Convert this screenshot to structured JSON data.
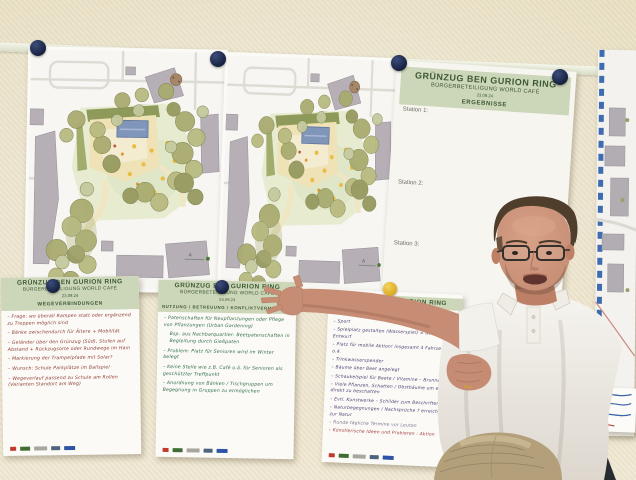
{
  "colors": {
    "wall": "#ece4cc",
    "poster_band": "#ccd6b8",
    "band_text": "#3d5a33",
    "magnet_navy": "#1c2844",
    "magnet_yellow": "#e3b52e",
    "ink_red": "#8c3a2e",
    "ink_green": "#2e6b44",
    "ink_purple": "#4a3b6e"
  },
  "results_poster": {
    "title": "GRÜNZUG BEN GURION RING",
    "subtitle": "BÜRGERBETEILIGUNG WORLD CAFÉ",
    "date": "23.09.24",
    "section": "ERGEBNISSE",
    "stations": [
      "Station 1:",
      "Station 2:",
      "Station 3:"
    ]
  },
  "note_posters": [
    {
      "title": "GRÜNZUG BEN GURION RING",
      "subtitle": "BÜRGERBETEILIGUNG WORLD CAFÉ",
      "date": "23.09.24",
      "section": "WEGEVERBINDUNGEN",
      "items": [
        "– Frage: wo überall Rampen statt oder ergänzend zu Treppen möglich sind",
        "– Bänke zwischendurch für Ältere + Mobilität",
        "– Geländer über den Grünzug (Süd), Stufen auf Abstand + Rückzugsorte oder Rundwege im Hain",
        "– Markierung der Trampelpfade mit Solar?",
        "– Wunsch: Schule Parkplätze im Ballspiel",
        "– Wegeverlauf passend zu Schule am Rollen (Varianten Standort am Weg)"
      ]
    },
    {
      "title": "GRÜNZUG BEN GURION RING",
      "subtitle": "BÜRGERBETEILIGUNG WORLD CAFÉ",
      "date": "23.09.24",
      "section": "NUTZUNG / BETREUUNG / KONFLIKTVERMEIDUNG",
      "items": [
        "– Patenschaften für Neupflanzungen oder Pflege von Pflanzungen (Urban Gardening)",
        "Bsp. aus Nachbarquartier: Beetpatenschaften in Begleitung durch Gießpaten",
        "– Problem: Platz für Senioren wird im Winter belegt",
        "– Keine Stelle wie z.B. Café o.ä. für Senioren als geschützter Treffpunkt",
        "– Anordnung von Bänken / Tischgruppen um Begegnung in Gruppen zu ermöglichen"
      ]
    },
    {
      "title": "GRÜNZUG BEN GURION RING",
      "items": [
        "– Sport",
        "– Spielplatz gestalten (Wasserspiel) = Bank–Tisch–Entwurf",
        "– Platz für mobile Aktion! insgesamt 4 Fahrzeuge o.ä.",
        "– Trinkwasserspender",
        "– Bäume über Beet angelegt",
        "– Schaukelspiel für Beete / Vitamine – Brunnen",
        "– Viele Pflanzen, Schatten / Obstbäume um evtl. so direkt zu beschatten",
        "– Evtl. Kunstwerke – Schilder zum Beschriften",
        "– Naturbegegnungen / Nachsprüche ? erreichbar zur Natur",
        "– Runde tägliche Termine vor Leuten",
        "– Künstlerische Ideen und Probieren : Aktion"
      ]
    }
  ]
}
